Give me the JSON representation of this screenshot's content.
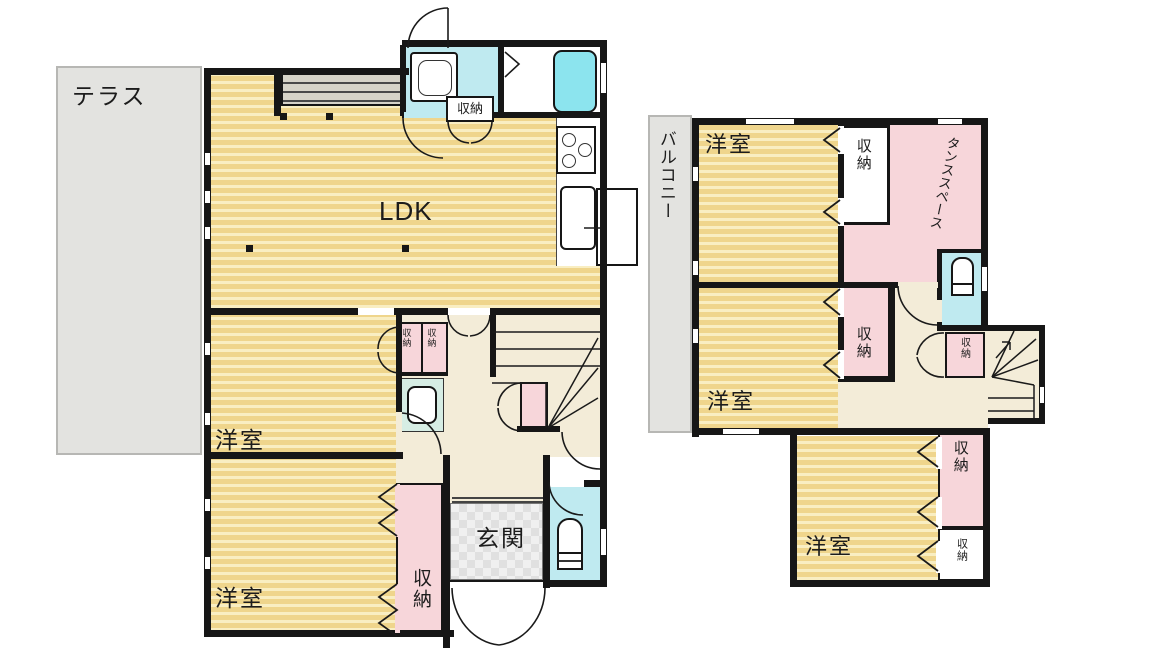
{
  "floor1": {
    "terrace_label": "テラス",
    "ldk_label": "LDK",
    "bedroom_mid_label": "洋室",
    "bedroom_bottom_label": "洋室",
    "entrance_label": "玄関",
    "storage_washroom_label": "収納",
    "storage_small_a_label": "収納",
    "storage_small_b_label": "収納",
    "storage_entry_label": "収納"
  },
  "floor2": {
    "balcony_label": "バルコニー",
    "bedroom1_label": "洋室",
    "bedroom2_label": "洋室",
    "bedroom3_label": "洋室",
    "tansu_label": "タンススペース",
    "storage_bedroom1_label": "収納",
    "storage_bedroom2_label": "収納",
    "storage_hall_label": "収納",
    "storage_bedroom3_upper_label": "収納",
    "storage_bedroom3_lower_label": "収納"
  },
  "fixtures": {
    "bathtub": "bathtub-icon",
    "vanity": "washbasin-icon",
    "washbasin": "washbasin-icon",
    "toilet_1f": "toilet-icon",
    "toilet_2f": "toilet-icon",
    "stove": "stove-icon",
    "kitchen_sink": "kitchen-sink-icon",
    "refrigerator": "refrigerator-icon",
    "stairs_1f": "staircase-icon",
    "stairs_2f": "staircase-icon"
  },
  "colors": {
    "wall": "#161616",
    "floor_stripe_dark": "#efd58c",
    "floor_stripe_light": "#f9eec2",
    "hall": "#f3ecd8",
    "wet_area": "#bfeaf0",
    "bathtub": "#8ce4ee",
    "closet_pink": "#f7d6da",
    "terrace_gray": "#e3e3e0",
    "entrance_tile": "#e4e4e4"
  }
}
